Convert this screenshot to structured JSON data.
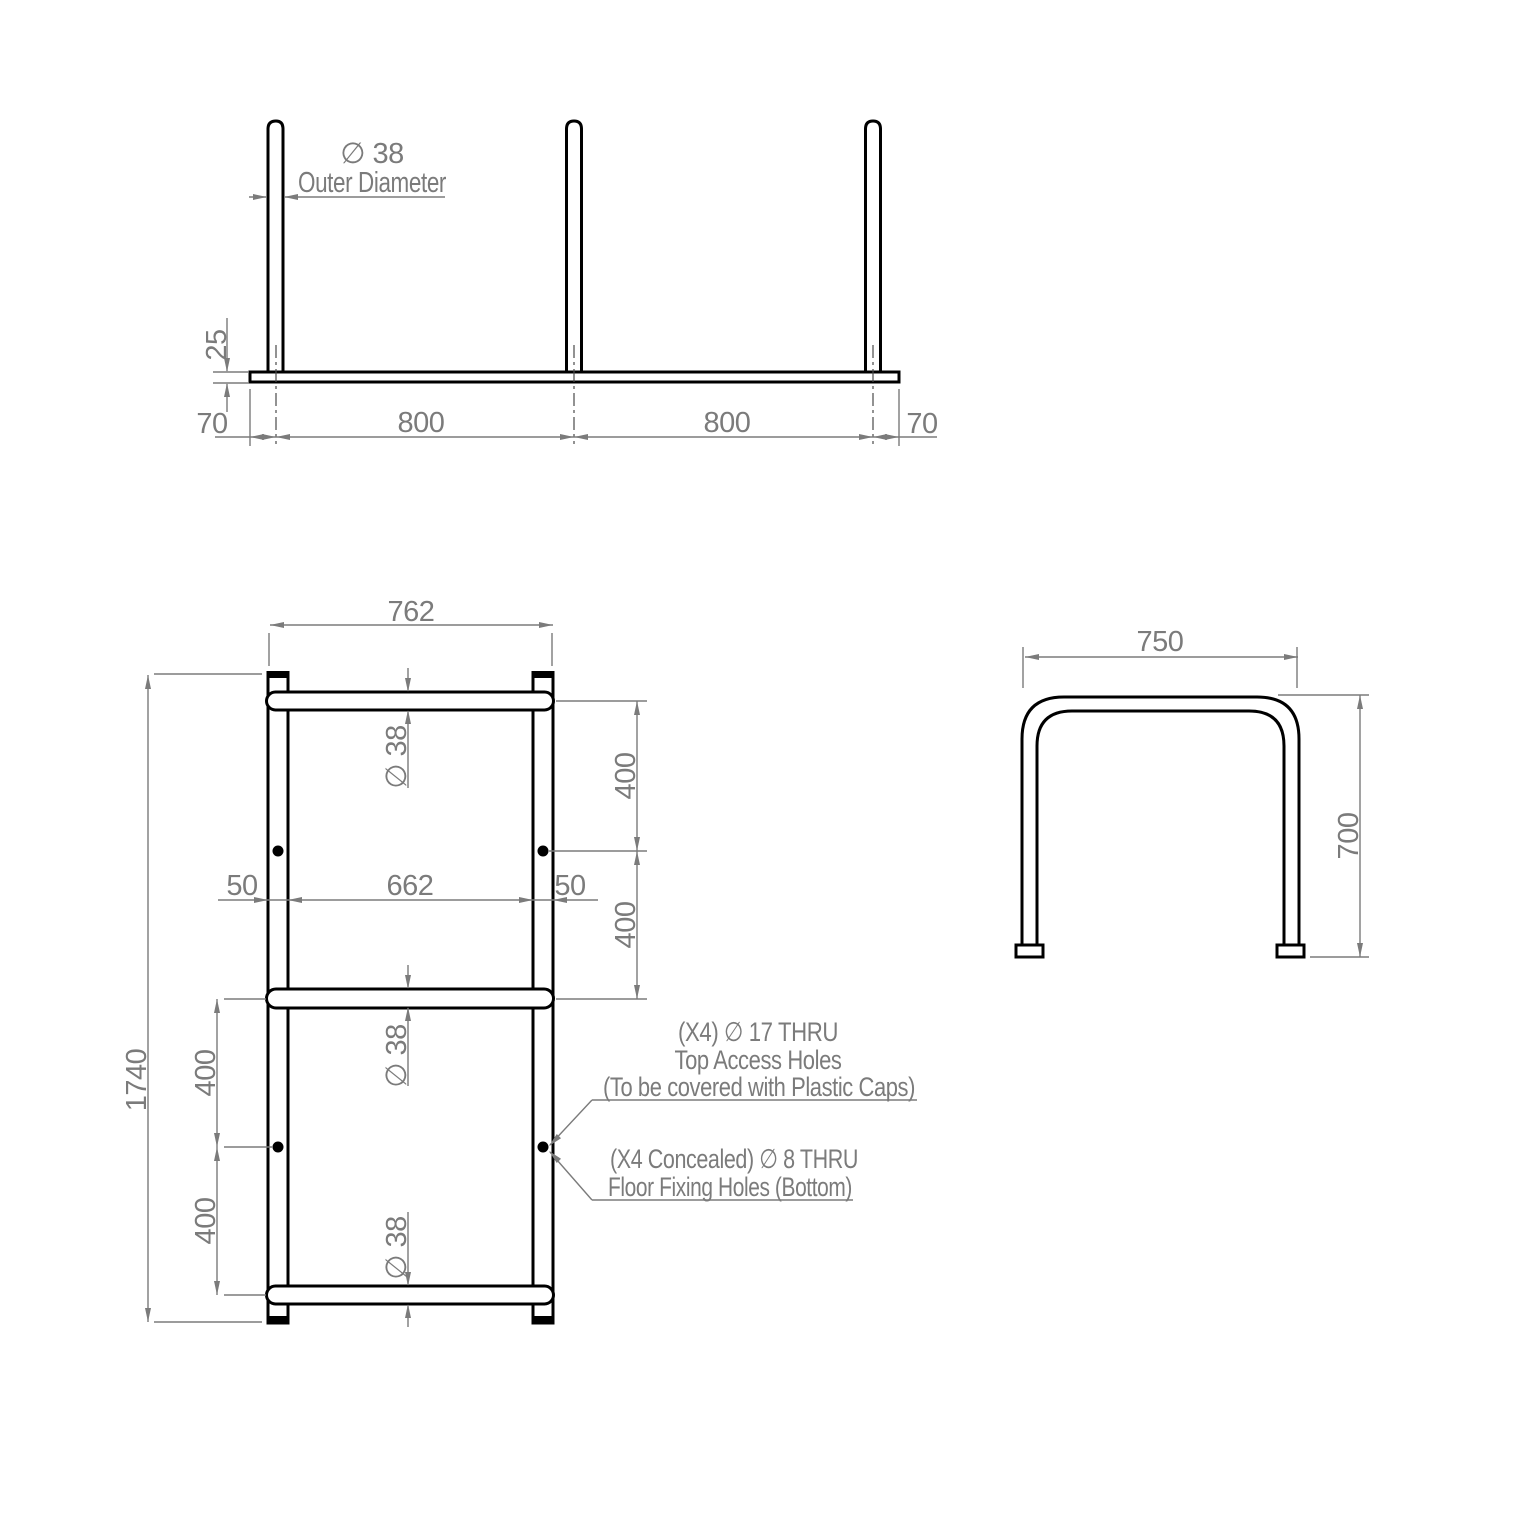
{
  "drawing": {
    "background": "#ffffff",
    "object_line_color": "#000000",
    "dimension_color": "#7b7b7b"
  },
  "top_view": {
    "dia_label": "∅ 38",
    "dia_caption": "Outer Diameter",
    "plate_thickness": "25",
    "left_margin": "70",
    "bay_1": "800",
    "bay_2": "800",
    "right_margin": "70"
  },
  "front_view": {
    "overall_width": "762",
    "overall_height": "1740",
    "rail_dia_top": "∅ 38",
    "rail_dia_middle": "∅ 38",
    "rail_dia_bottom": "∅ 38",
    "post_width_left": "50",
    "clear_width": "662",
    "post_width_right": "50",
    "right_spacing_upper": "400",
    "right_spacing_lower": "400",
    "left_spacing_upper": "400",
    "left_spacing_lower": "400",
    "callout_top_holes": {
      "line1": "(X4)  ∅ 17 THRU",
      "line2": "Top Access Holes",
      "line3": "(To be covered with Plastic Caps)"
    },
    "callout_floor_holes": {
      "line1": "(X4 Concealed) ∅ 8 THRU",
      "line2": "Floor Fixing Holes (Bottom)"
    }
  },
  "side_view": {
    "width": "750",
    "height": "700"
  }
}
